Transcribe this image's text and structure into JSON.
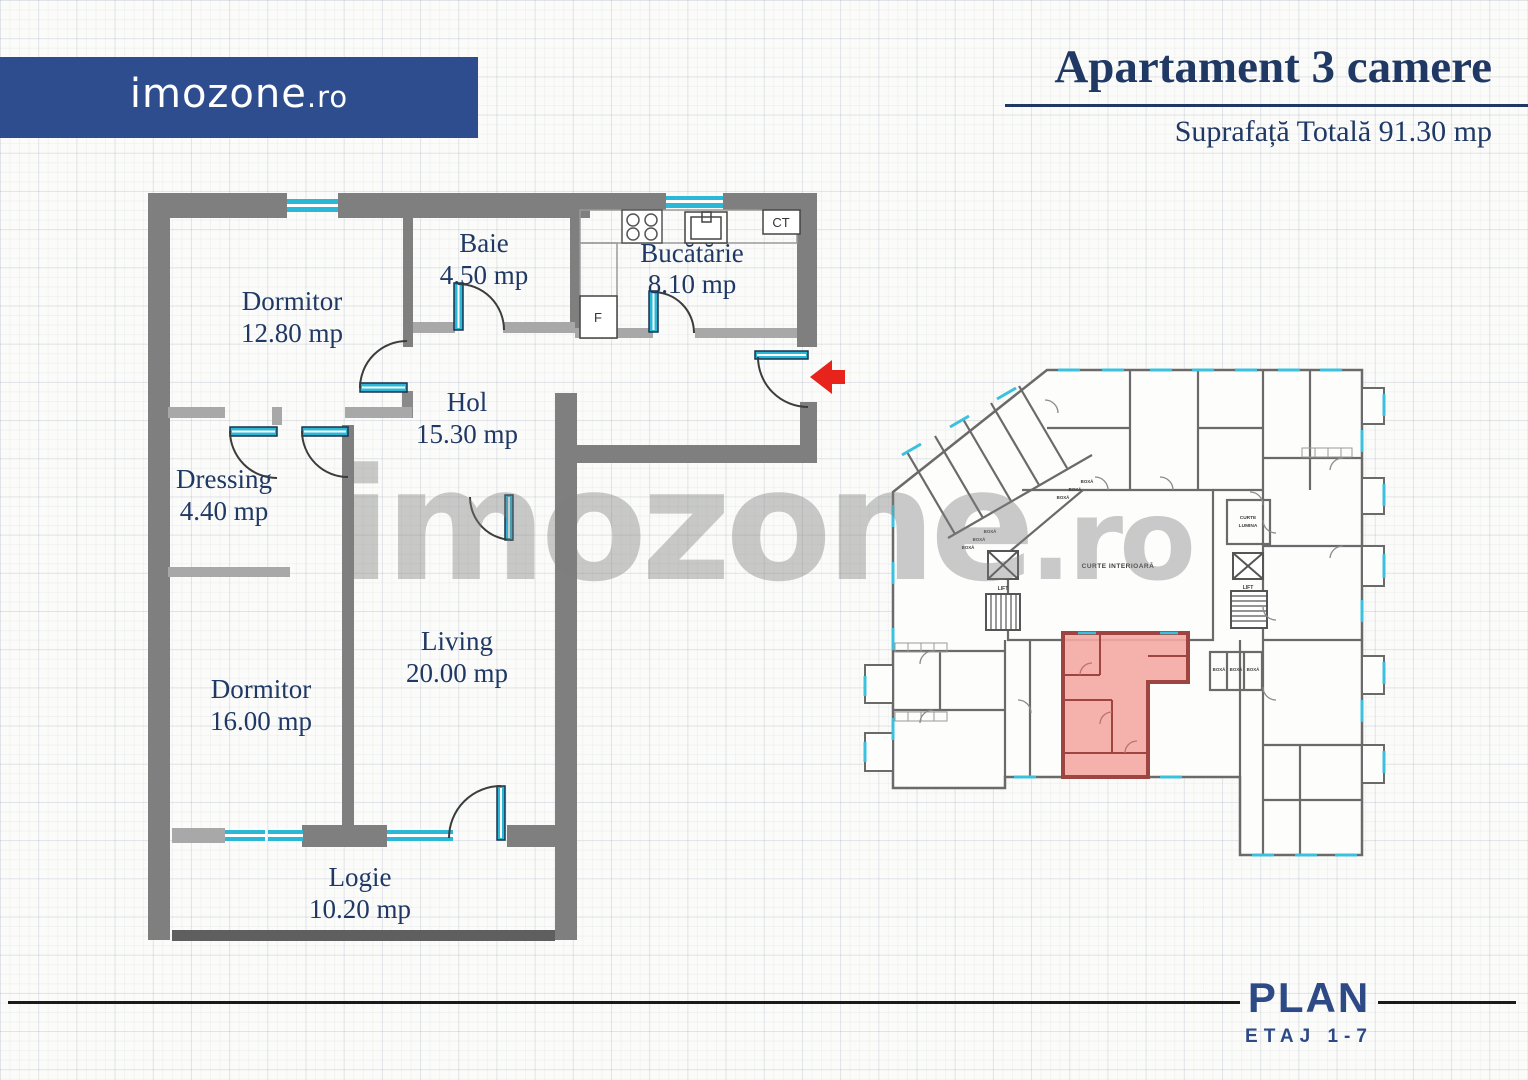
{
  "brand": {
    "logo_text": "imozone",
    "logo_tld": ".ro"
  },
  "header": {
    "title": "Apartament 3 camere",
    "subtitle": "Suprafață Totală 91.30 mp"
  },
  "watermark": {
    "text": "imozone",
    "tld": ".ro"
  },
  "apartment_plan": {
    "rooms": [
      {
        "id": "dormitor-1",
        "name": "Dormitor",
        "area": "12.80 mp"
      },
      {
        "id": "baie",
        "name": "Baie",
        "area": "4.50 mp"
      },
      {
        "id": "bucatarie",
        "name": "Bucătărie",
        "area": "8.10 mp"
      },
      {
        "id": "hol",
        "name": "Hol",
        "area": "15.30 mp"
      },
      {
        "id": "dressing",
        "name": "Dressing",
        "area": "4.40 mp"
      },
      {
        "id": "dormitor-2",
        "name": "Dormitor",
        "area": "16.00 mp"
      },
      {
        "id": "living",
        "name": "Living",
        "area": "20.00 mp"
      },
      {
        "id": "logie",
        "name": "Logie",
        "area": "10.20 mp"
      }
    ],
    "labels": {
      "boiler": "CT",
      "fridge": "F"
    }
  },
  "site_plan": {
    "courtyard": "CURTE INTERIOARĂ",
    "light_court_line1": "CURTE",
    "light_court_line2": "LUMINA",
    "lift": "LIFT",
    "storage_box": "BOXĂ"
  },
  "footer": {
    "plan": "PLAN",
    "floors": "ETAJ 1-7"
  },
  "colors": {
    "accent_blue": "#2e4d8e",
    "text_navy": "#1f3864",
    "wall_gray": "#7f7f7f",
    "wall_light_gray": "#a8a8a8",
    "window_cyan": "#2bb7d6",
    "arrow_red": "#e8231c",
    "unit_fill": "#f4a8a3",
    "unit_wall": "#9e4441",
    "footer_blue": "#2d4a87"
  }
}
